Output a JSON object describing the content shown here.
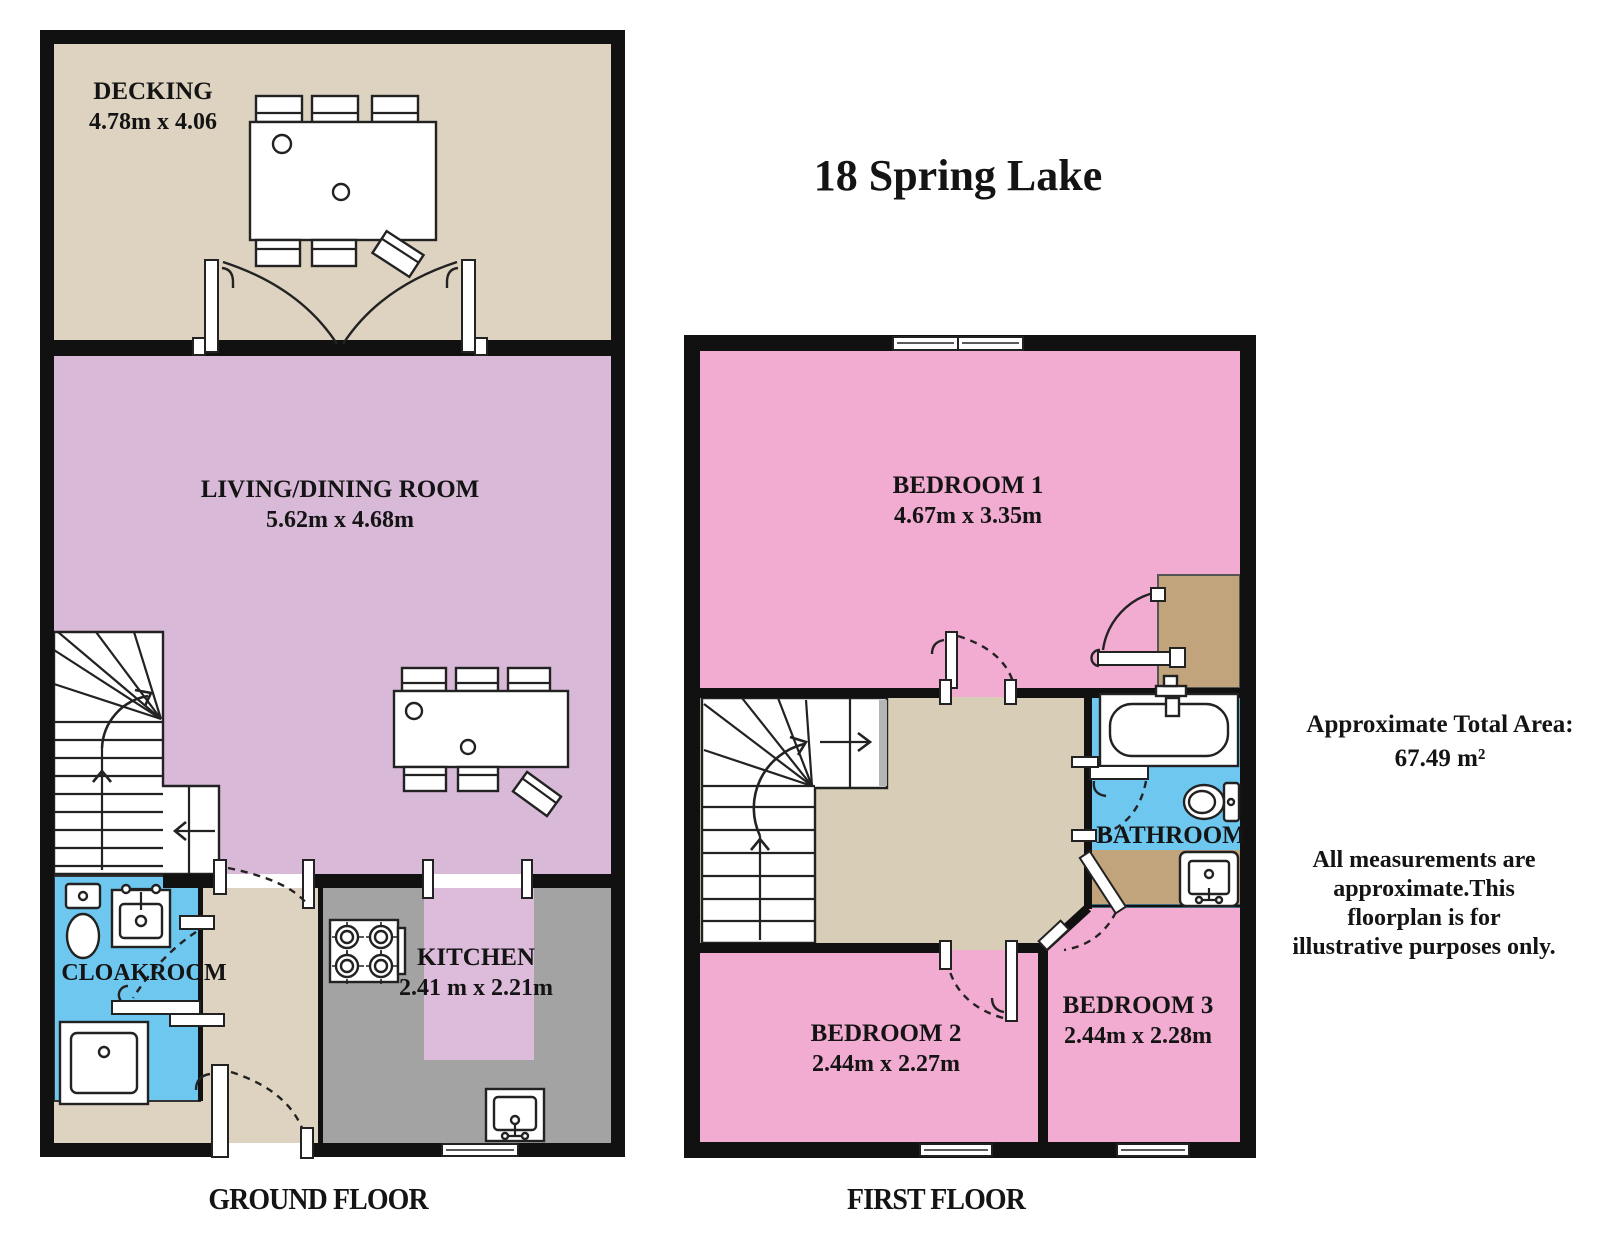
{
  "title": "18 Spring Lake",
  "ground_floor": {
    "label": "GROUND FLOOR",
    "decking": {
      "name": "DECKING",
      "dims": "4.78m x 4.06"
    },
    "living_dining": {
      "name": "LIVING/DINING ROOM",
      "dims": "5.62m x 4.68m"
    },
    "cloakroom": {
      "name": "CLOAKROOM"
    },
    "kitchen": {
      "name": "KITCHEN",
      "dims": "2.41 m x 2.21m"
    }
  },
  "first_floor": {
    "label": "FIRST FLOOR",
    "bedroom1": {
      "name": "BEDROOM 1",
      "dims": "4.67m x 3.35m"
    },
    "bathroom": {
      "name": "BATHROOM"
    },
    "bedroom2": {
      "name": "BEDROOM 2",
      "dims": "2.44m x 2.27m"
    },
    "bedroom3": {
      "name": "BEDROOM 3",
      "dims": "2.44m x 2.28m"
    }
  },
  "annotations": {
    "total_area_label": "Approximate Total Area:",
    "total_area_value": "67.49 m²",
    "disclaimer_lines": [
      "All measurements are",
      "approximate.This",
      "floorplan is for",
      "illustrative purposes only."
    ]
  },
  "colors": {
    "wall": "#111111",
    "decking_floor": "#ddd3c0",
    "living_floor": "#d9b9d8",
    "bedroom_floor": "#f2abd1",
    "bathroom_floor": "#6ec7ef",
    "kitchen_floor": "#a3a3a3",
    "kitchen_accent": "#dcbcda",
    "landing_floor": "#d8ceb8",
    "wardrobe_floor": "#c1a37c"
  }
}
